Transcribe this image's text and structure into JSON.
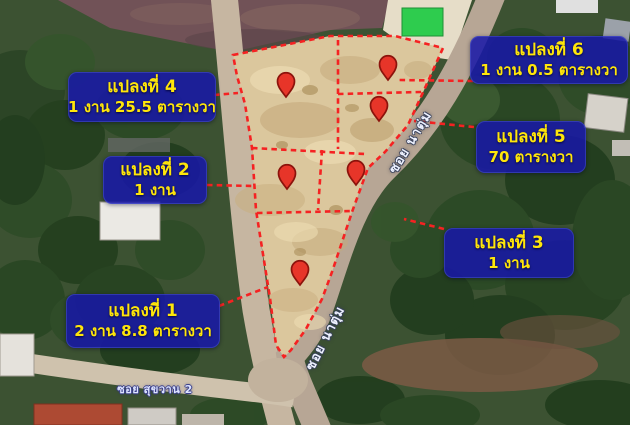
{
  "map": {
    "plots": [
      {
        "id": 1,
        "title": "แปลงที่ 1",
        "area": "2 งาน 8.8 ตารางวา"
      },
      {
        "id": 2,
        "title": "แปลงที่ 2",
        "area": "1 งาน"
      },
      {
        "id": 3,
        "title": "แปลงที่ 3",
        "area": "1 งาน"
      },
      {
        "id": 4,
        "title": "แปลงที่ 4",
        "area": "1 งาน 25.5 ตารางวา"
      },
      {
        "id": 5,
        "title": "แปลงที่ 5",
        "area": "70 ตารางวา"
      },
      {
        "id": 6,
        "title": "แปลงที่ 6",
        "area": "1 งาน 0.5 ตารางวา"
      }
    ],
    "road_labels": {
      "diagonal_road_upper": "ซอย นาตุ่ม",
      "diagonal_road_lower": "ซอย นาตุ่ม",
      "bottom_street": "ซอย สุขวาน 2"
    },
    "icons": {
      "pin": "map-pin-icon"
    },
    "colors": {
      "label_box_bg": "#1717a8",
      "label_text_yellow": "#ffe60a",
      "boundary_red": "#f52222",
      "pin_red": "#e73529",
      "plot_ground_tan": "#dbc79d",
      "road_gray": "#b7a695",
      "tree_green": "#2c4526"
    }
  }
}
